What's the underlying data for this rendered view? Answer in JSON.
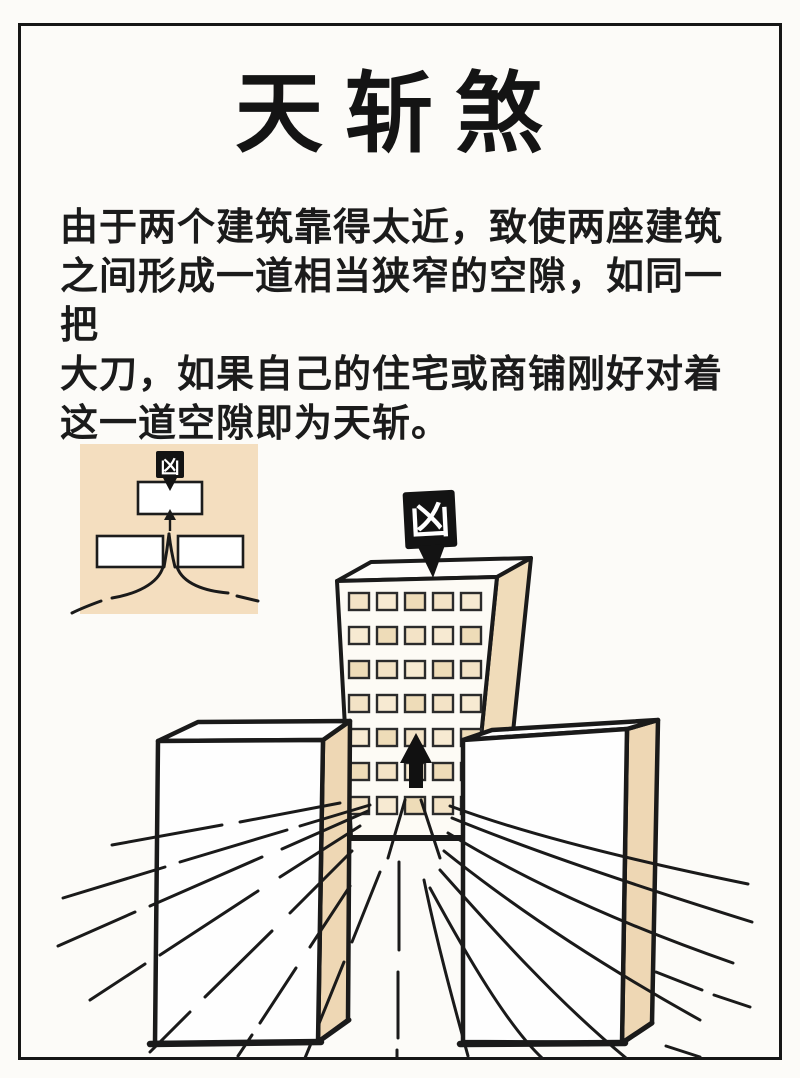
{
  "title": {
    "text": "天斩煞"
  },
  "description": {
    "lines": [
      "由于两个建筑靠得太近，致使两座建筑",
      "之间形成一道相当狭窄的空隙，如同一把",
      "大刀，如果自己的住宅或商铺刚好对着",
      "这一道空隙即为天斩。"
    ]
  },
  "inset_diagram": {
    "marker_label": "凶",
    "meaning": "top view: two close buildings form a narrow gap aimed at a third building"
  },
  "main_illustration": {
    "marker_label": "凶",
    "windows": {
      "rows": 7,
      "cols": 5
    }
  },
  "colors": {
    "paper": "#fcfbf8",
    "ink": "#1a1a1a",
    "inset_background": "#f4debf",
    "building_side": "#eed7b4",
    "window_fill": "#f3e3c6",
    "marker_fill": "#131313",
    "marker_text": "#ffffff"
  }
}
